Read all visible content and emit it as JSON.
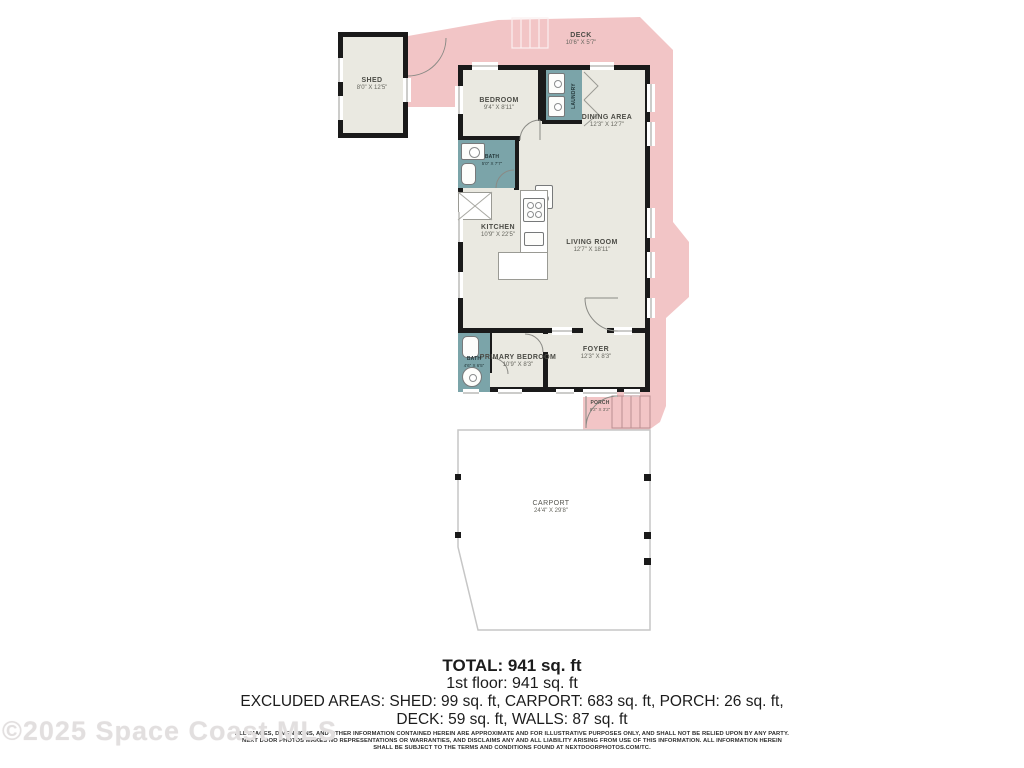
{
  "colors": {
    "excluded_area_pink": "#f2c5c6",
    "room_fill": "#eae9e1",
    "bath_teal": "#7ba4a9",
    "wall_black": "#1a1a1a"
  },
  "watermark": "©2025 Space Coast MLS",
  "rooms": {
    "shed": {
      "name": "SHED",
      "dims": "8'0\" X 12'5\""
    },
    "deck": {
      "name": "DECK",
      "dims": "10'6\" X 5'7\""
    },
    "bedroom": {
      "name": "BEDROOM",
      "dims": "9'4\" X 8'11\""
    },
    "laundry": {
      "name": "LAUNDRY"
    },
    "dining": {
      "name": "DINING AREA",
      "dims": "12'3\" X 12'7\""
    },
    "bath1": {
      "name": "BATH",
      "dims": "5'0\" X 7'7\""
    },
    "kitchen": {
      "name": "KITCHEN",
      "dims": "10'9\" X 22'5\""
    },
    "living": {
      "name": "LIVING ROOM",
      "dims": "12'7\" X 18'11\""
    },
    "primary_bedroom": {
      "name": "PRIMARY BEDROOM",
      "dims": "10'9\" X 8'3\""
    },
    "bath2": {
      "name": "BATH",
      "dims": "4'6\" X 6'5\""
    },
    "foyer": {
      "name": "FOYER",
      "dims": "12'3\" X 8'3\""
    },
    "porch": {
      "name": "PORCH",
      "dims": "8'2\" X 3'2\""
    },
    "carport": {
      "name": "CARPORT",
      "dims": "24'4\" X 29'8\""
    }
  },
  "summary": {
    "total": "TOTAL: 941 sq. ft",
    "first_floor": "1st floor: 941 sq. ft",
    "excluded_line1": "EXCLUDED AREAS: SHED: 99 sq. ft, CARPORT: 683 sq. ft, PORCH: 26 sq. ft,",
    "excluded_line2": "DECK: 59 sq. ft, WALLS: 87 sq. ft"
  },
  "disclaimer": {
    "line1": "ALL IMAGES, DIMENSIONS, AND OTHER INFORMATION CONTAINED HEREIN ARE APPROXIMATE AND FOR ILLUSTRATIVE PURPOSES ONLY, AND SHALL NOT BE RELIED UPON BY ANY PARTY.",
    "line2": "NEXT DOOR PHOTOS MAKES NO REPRESENTATIONS OR WARRANTIES, AND DISCLAIMS ANY AND ALL LIABILITY ARISING FROM USE OF THIS INFORMATION. ALL INFORMATION HEREIN",
    "line3": "SHALL BE SUBJECT TO THE TERMS AND CONDITIONS FOUND AT NEXTDOORPHOTOS.COM/TC."
  }
}
